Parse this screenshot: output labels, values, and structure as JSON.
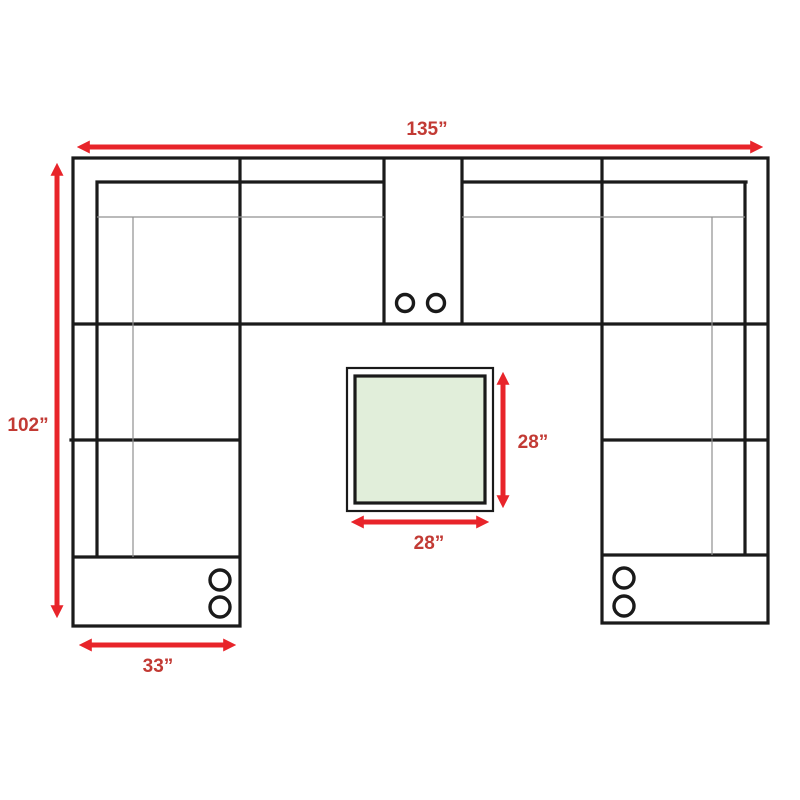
{
  "diagram": {
    "title": "U-shaped sectional sofa floor plan with center table and dimensions",
    "labels": {
      "overall_width": "135”",
      "overall_depth": "102”",
      "arm_width": "33”",
      "table_depth": "28”",
      "table_width": "28”"
    },
    "colors": {
      "outline": "#1a1a1a",
      "seam_line": "#909090",
      "arrow": "#e8242a",
      "label_text": "#c23a34",
      "table_fill": "#e1eeda",
      "background": "#ffffff"
    },
    "parts": {
      "sofa": "u-shaped sectional, open side facing down",
      "consoles": "three consoles with two cupholders each (top center, bottom of left arm, bottom of right arm)",
      "table": "square table / ottoman centered in the U opening",
      "cupholder_count": 6
    }
  }
}
